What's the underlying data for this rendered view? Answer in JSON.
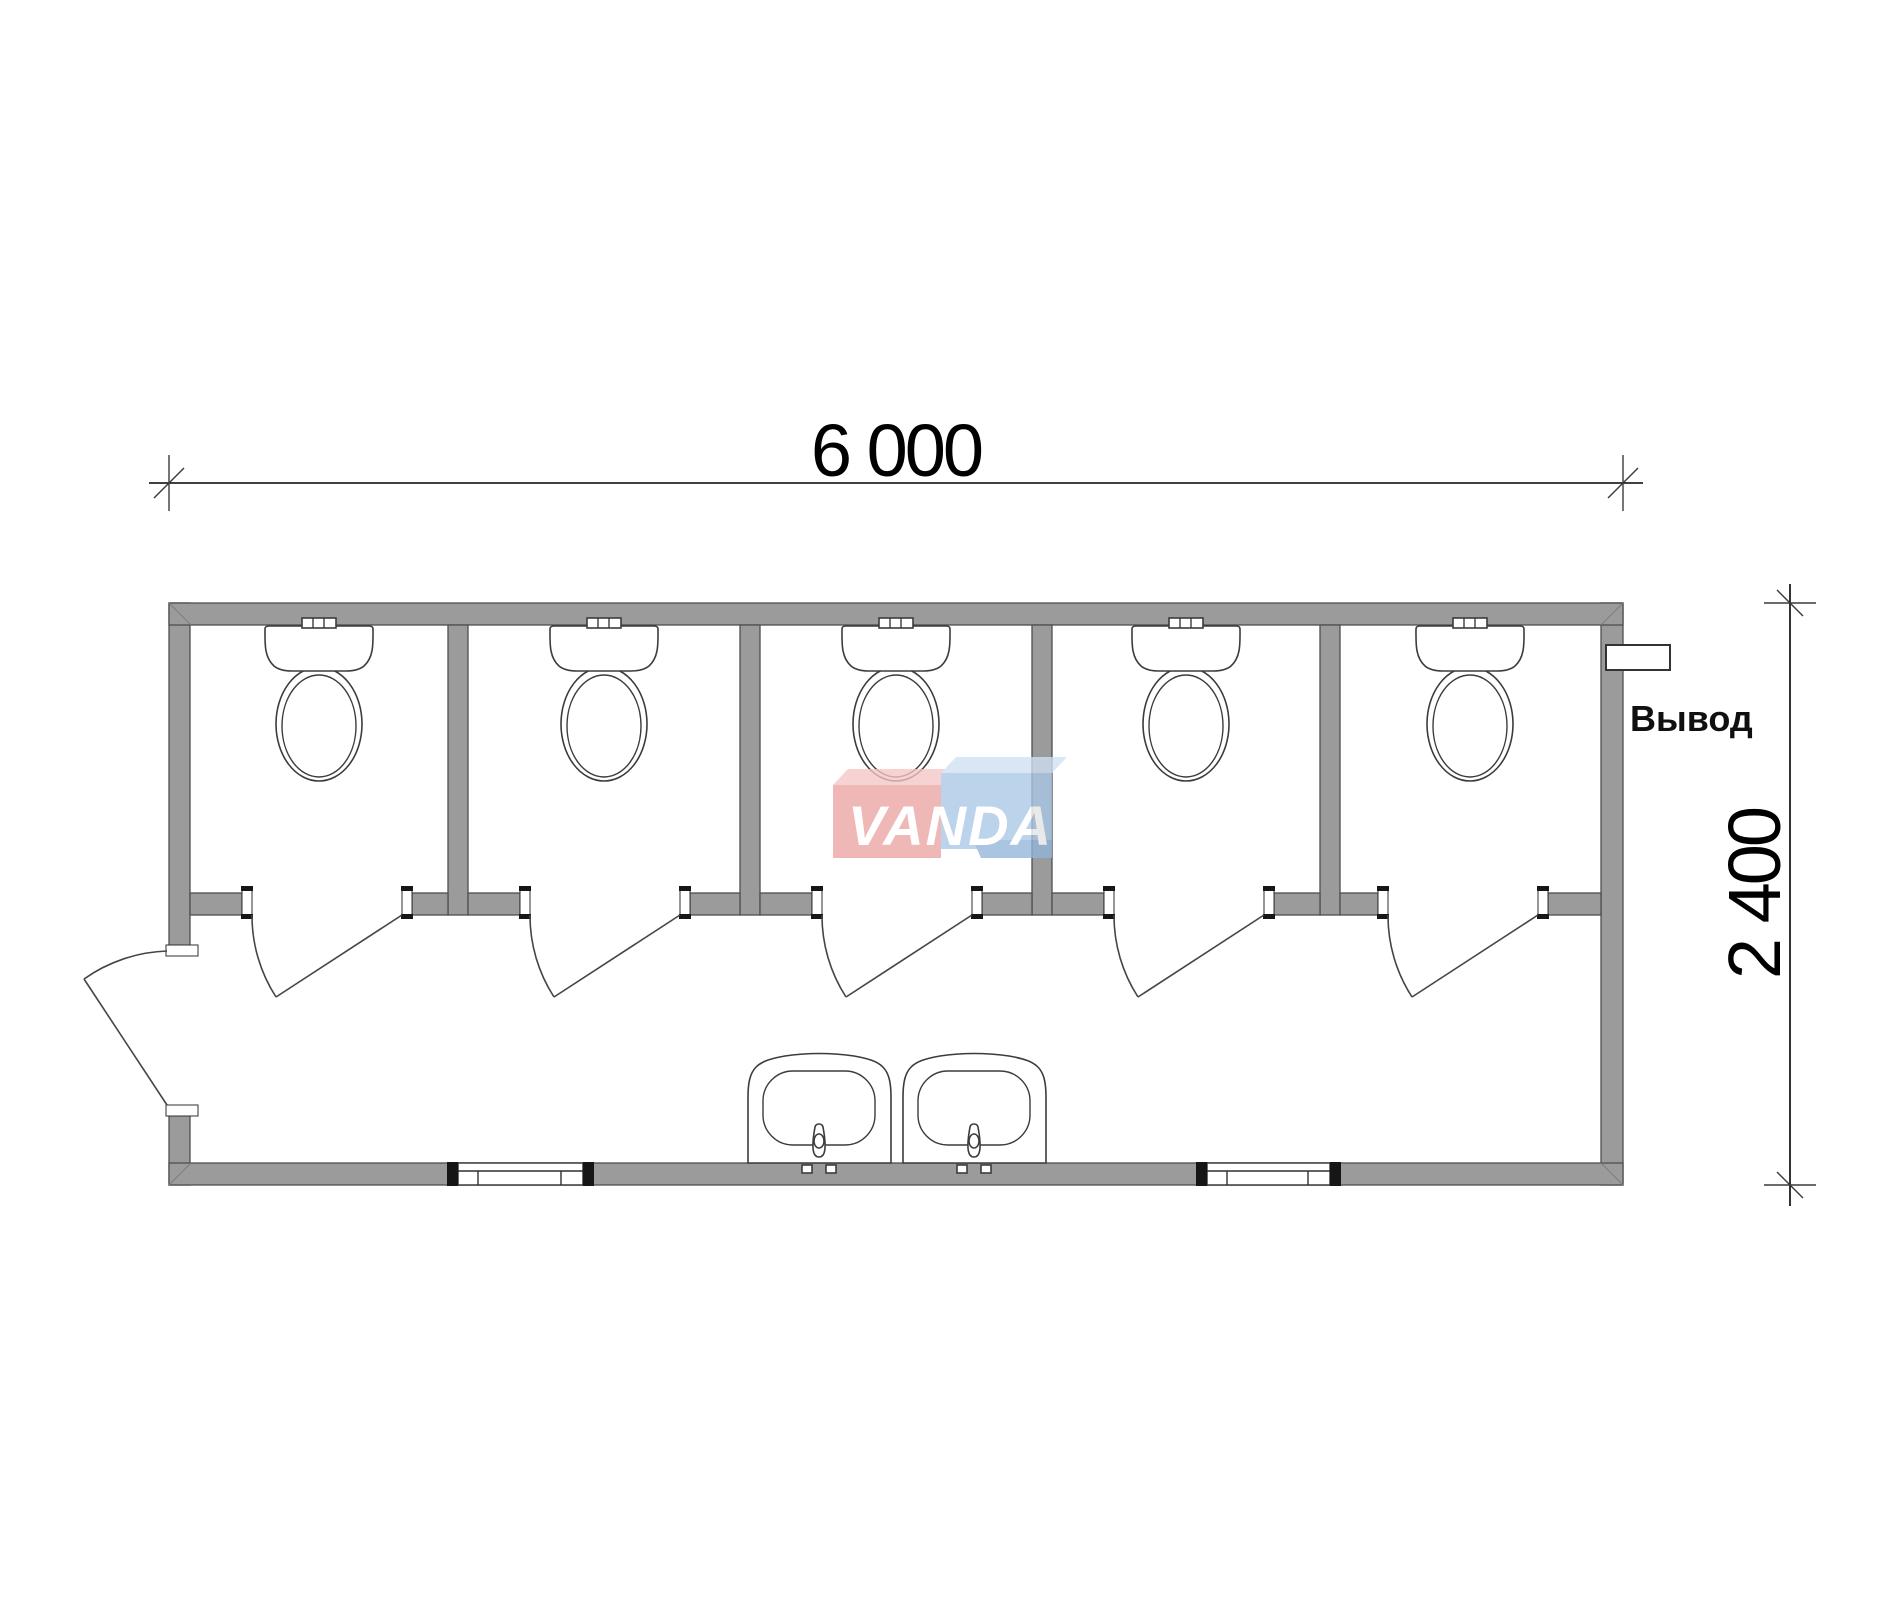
{
  "drawing": {
    "dimension_width": "6 000",
    "dimension_height": "2 400",
    "outlet_label": "Вывод",
    "watermark": "VANDA"
  },
  "plan": {
    "type": "sanitary-container-floor-plan",
    "overall_width_mm": "6 000",
    "overall_depth_mm": "2 400",
    "toilet_stalls": 5,
    "toilets": 5,
    "washbasins": 2,
    "stall_doors": 5,
    "entry_doors": 1,
    "windows": 2,
    "outlet_connections": 1
  },
  "colors": {
    "background": "#ffffff",
    "wall_fill": "#9b9b9b",
    "wall_outline": "#4f4f4f",
    "fixture_line": "#3c3c3c",
    "dimension_text": "#000000",
    "logo_red": "#eda3a3",
    "logo_red_top": "#f5c6c6",
    "logo_blue": "#aac7e7",
    "logo_blue_top": "#d0e0f2",
    "logo_blue_shadow": "#92b5da",
    "logo_text": "#ffffff"
  }
}
